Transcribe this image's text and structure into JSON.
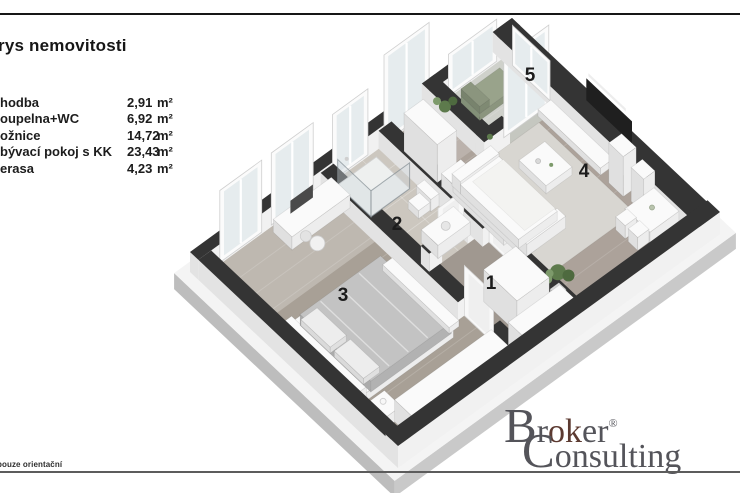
{
  "header": {
    "title": "rys nemovitosti"
  },
  "legend": {
    "rows": [
      {
        "label": "hodba",
        "value": "2,91",
        "unit": "m²"
      },
      {
        "label": "oupelna+WC",
        "value": "6,92",
        "unit": "m²"
      },
      {
        "label": "ožnice",
        "value": "14,72",
        "unit": "m²"
      },
      {
        "label": "bývací pokoj s KK",
        "value": "23,43",
        "unit": "m²"
      },
      {
        "label": "erasa",
        "value": "4,23",
        "unit": "m²"
      }
    ]
  },
  "floorplan": {
    "rooms": [
      {
        "number": "1"
      },
      {
        "number": "2"
      },
      {
        "number": "3"
      },
      {
        "number": "4"
      },
      {
        "number": "5"
      }
    ],
    "colors": {
      "wall_top": "#343434",
      "wall_face": "#f1f1f1",
      "wall_face2": "#e3e3e3",
      "slab_top": "#f4f4f4",
      "slab_face": "#c9c9c9",
      "slab_face2": "#bdbdbd",
      "wood_bedroom": "#a8a096",
      "wood_hall": "#a09890",
      "wood_living": "#aca29a",
      "tile_bath": "#ccc7bf",
      "terrace_floor": "#c5c7c0",
      "rug": "#d8d6d1",
      "furn_top": "#fafafa",
      "furn_face": "#ededed",
      "furn_face2": "#e0e0e0",
      "blanket": "#c3c3c3",
      "glass": "#e3eaec",
      "tv": "#1f1f1f",
      "plant_dark": "#4e6a3f",
      "plant_mid": "#5d7a4c",
      "plant_light": "#7d9a6b",
      "terrace_chair": "#99a38b",
      "label_color": "#1c1c1c",
      "top_line": "#161616",
      "bottom_line": "#5c5c5c"
    }
  },
  "footer": {
    "disclaimer": "pouze orientační"
  },
  "logo": {
    "line1_initial": "B",
    "line1_pre": "r",
    "line1_mark": "ok",
    "line1_post": "er",
    "registered": "®",
    "line2_initial": "C",
    "line2_rest": "onsulting",
    "accent": "#e0765c",
    "text_color": "#54545a"
  }
}
